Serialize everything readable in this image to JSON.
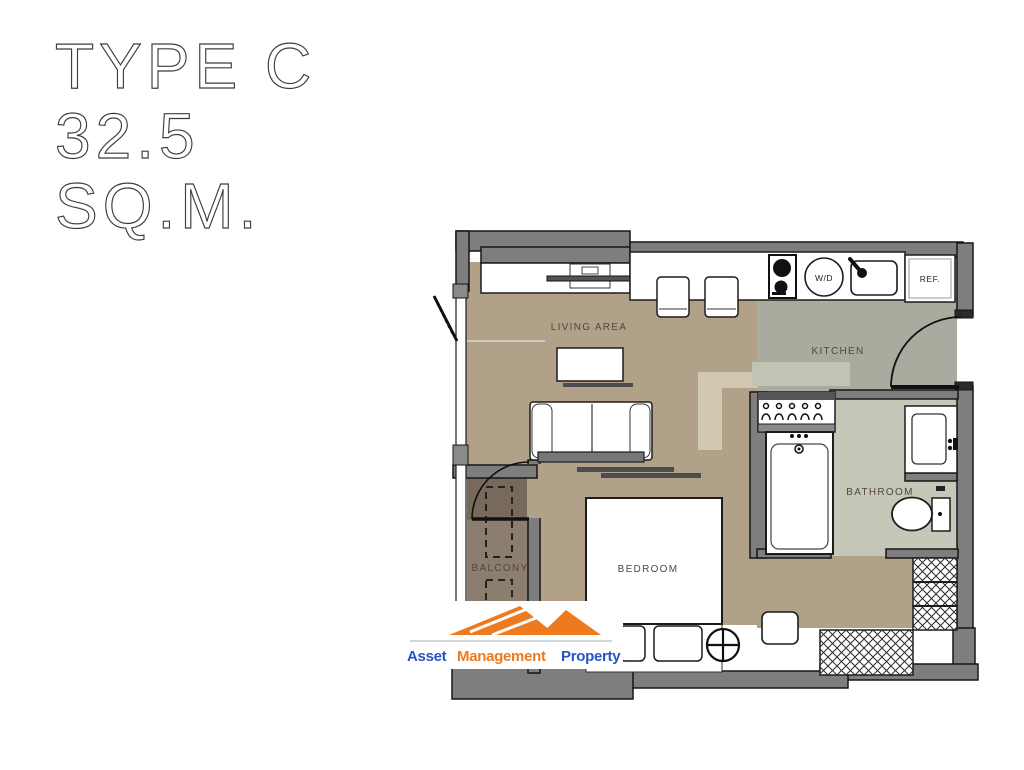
{
  "title": {
    "line1": "TYPE C",
    "line2": "32.5",
    "line3": "SQ.M."
  },
  "plan": {
    "labels": {
      "living": "LIVING AREA",
      "kitchen": "KITCHEN",
      "bathroom": "BATHROOM",
      "bedroom": "BEDROOM",
      "balcony": "BALCONY",
      "washer_dryer": "W/D",
      "fridge": "REF."
    },
    "colors": {
      "floor_living": "#b2a189",
      "floor_bedroom": "#b2a189",
      "floor_kitchen": "#a8ab9d",
      "floor_bathroom": "#c5c7b9",
      "floor_balcony": "#8b7e6f",
      "floor_balcony_shade": "#776a5c",
      "highlight_tan": "#d2c7b0",
      "highlight_green": "#c0c4b4",
      "wall": "#7e7e7e",
      "outline": "#1a1a1a"
    }
  },
  "logo": {
    "mountain_color": "#ee7a1f",
    "divider_color": "#a7adb5",
    "words": [
      {
        "text": "Asset",
        "color": "#2653c6"
      },
      {
        "text": "Management",
        "color": "#ee7a1f"
      },
      {
        "text": "Property",
        "color": "#2653c6"
      }
    ]
  }
}
